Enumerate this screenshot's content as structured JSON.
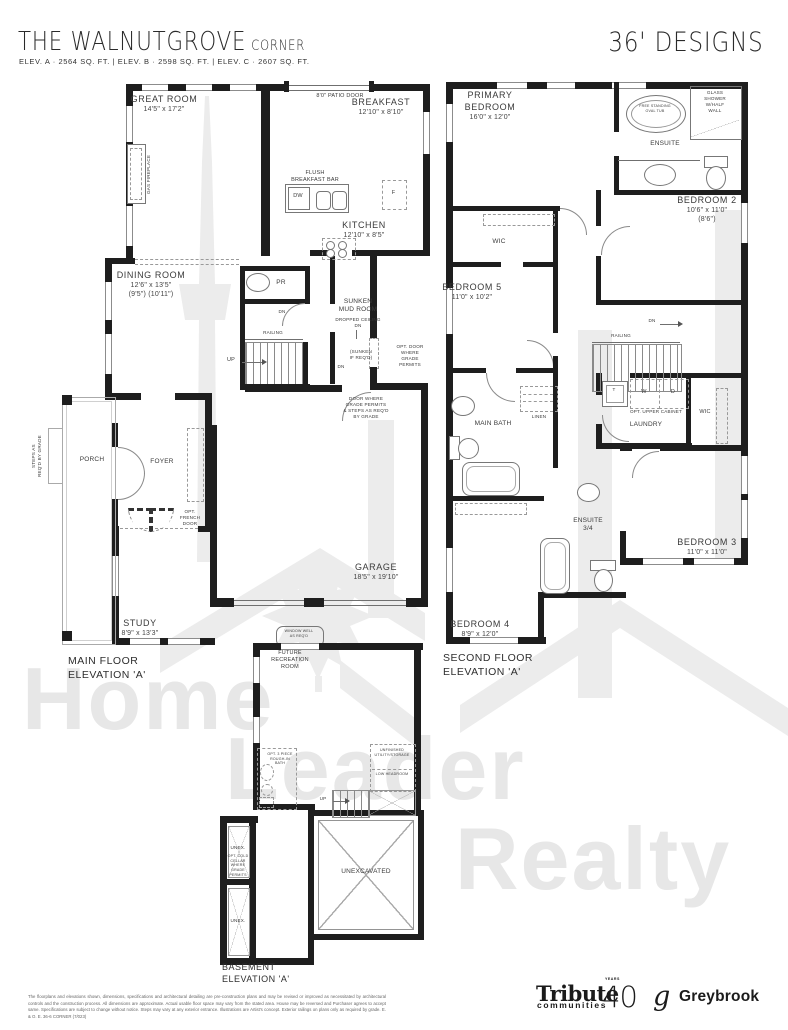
{
  "header": {
    "title": "THE WALNUTGROVE",
    "title_suffix": "CORNER",
    "elevations": "ELEV. A · 2564 SQ. FT.   |   ELEV. B · 2598 SQ. FT.   |   ELEV. C · 2607 SQ. FT.",
    "series": "36' DESIGNS"
  },
  "watermark": {
    "word1": "Home",
    "word2": "Leader",
    "word3": "Realty"
  },
  "main_floor": {
    "caption": "MAIN FLOOR\nELEVATION 'A'",
    "great_room_name": "GREAT ROOM",
    "great_room_dims": "14'5\" x 17'2\"",
    "patio_door": "8'0\" PATIO DOOR",
    "breakfast_name": "BREAKFAST",
    "breakfast_dims": "12'10\" x 8'10\"",
    "flush_bar": "FLUSH\nBREAKFAST BAR",
    "dw": "DW",
    "fridge": "F",
    "kitchen_name": "KITCHEN",
    "kitchen_dims": "12'10\" x 8'5\"",
    "gas_fireplace": "GAS FIREPLACE",
    "dining_name": "DINING ROOM",
    "dining_dims": "12'6\" x 13'5\"",
    "dining_dims_alt": "(9'5\") (10'11\")",
    "powder_room": "PR",
    "mud_room": "SUNKEN\nMUD ROOM",
    "dropped_ceiling": "DROPPED CEILING",
    "dn_mud": "DN",
    "dn_hall": "DN",
    "railing": "RAILING",
    "up": "UP",
    "sunken_if_reqd": "(SUNKEN\nIF REQ'D)",
    "dn_stair": "DN",
    "opt_door_grade": "OPT. DOOR\nWHERE\nGRADE\nPERMITS",
    "door_grade": "DOOR WHERE\nGRADE PERMITS\n& STEPS AS REQ'D\nBY GRADE",
    "porch": "PORCH",
    "foyer": "FOYER",
    "opt_french_door": "OPT.\nFRENCH\nDOOR",
    "steps_grade": "STEPS AS\nREQ'D BY GRADE",
    "study_name": "STUDY",
    "study_dims": "8'9\" x 13'3\"",
    "garage_name": "GARAGE",
    "garage_dims": "18'5\" x 19'10\""
  },
  "second_floor": {
    "caption": "SECOND FLOOR\nELEVATION 'A'",
    "primary_name": "PRIMARY\nBEDROOM",
    "primary_dims": "16'0\" x 12'0\"",
    "oval_tub": "FREE STANDING\nOVAL TUB",
    "glass_shower": "GLASS\nSHOWER\nW/HALF\nWALL",
    "ensuite": "ENSUITE",
    "bedroom2_name": "BEDROOM 2",
    "bedroom2_dims": "10'6\" x 11'0\"",
    "bedroom2_dims_alt": "(8'6\")",
    "wic_primary": "WIC",
    "bedroom5_name": "BEDROOM 5",
    "bedroom5_dims": "11'0\" x 10'2\"",
    "dn": "DN",
    "railing": "RAILING",
    "main_bath": "MAIN BATH",
    "linen": "LINEN",
    "tub_t": "T",
    "washer": "W",
    "dryer": "D",
    "opt_upper_cabinet": "OPT. UPPER CABINET",
    "laundry": "LAUNDRY",
    "wic_bedroom3": "WIC",
    "ensuite_34": "ENSUITE\n3/4",
    "bedroom3_name": "BEDROOM 3",
    "bedroom3_dims": "11'0\" x 11'0\"",
    "bedroom4_name": "BEDROOM 4",
    "bedroom4_dims": "8'9\" x 12'0\""
  },
  "basement": {
    "caption": "BASEMENT\nELEVATION 'A'",
    "window_well": "WINDOW WELL\nAS REQ'D",
    "future_rec_room": "FUTURE\nRECREATION\nROOM",
    "opt_bath": "OPT. 3 PIECE\nROUGH-IN\nBATH",
    "unfinished_utility": "UNFINISHED\nUTILITY/STORAGE",
    "low_headroom": "LOW HEADROOM",
    "up": "UP",
    "unex_top": "UNEX.",
    "cold_cellar": "OPT. COLD\nCELLAR\nWHERE\nGRADE\nPERMITS",
    "unex_bottom": "UNEX.",
    "unexcavated": "UNEXCAVATED"
  },
  "footer": {
    "disclaimer": "The floorplans and elevations shown, dimensions, specifications and architectural detailing are pre-construction plans and may be revised or improved as necessitated by architectural controls and the construction process. All dimensions are approximate. Actual usable floor space may vary from the stated area. House may be reversed and Purchaser agrees to accept same. Specifications are subject to change without notice. Steps may vary at any exterior entrance. Illustrations are Artist's concept. Exterior railings on plans only as required by grade. E. & O. E. 36-6 CORNER (7/023)",
    "tribute_name": "Tribute",
    "tribute_sub": "communities",
    "tribute_number": "40",
    "tribute_years": "YEARS",
    "greybrook_mark": "g",
    "greybrook_name": "Greybrook"
  }
}
